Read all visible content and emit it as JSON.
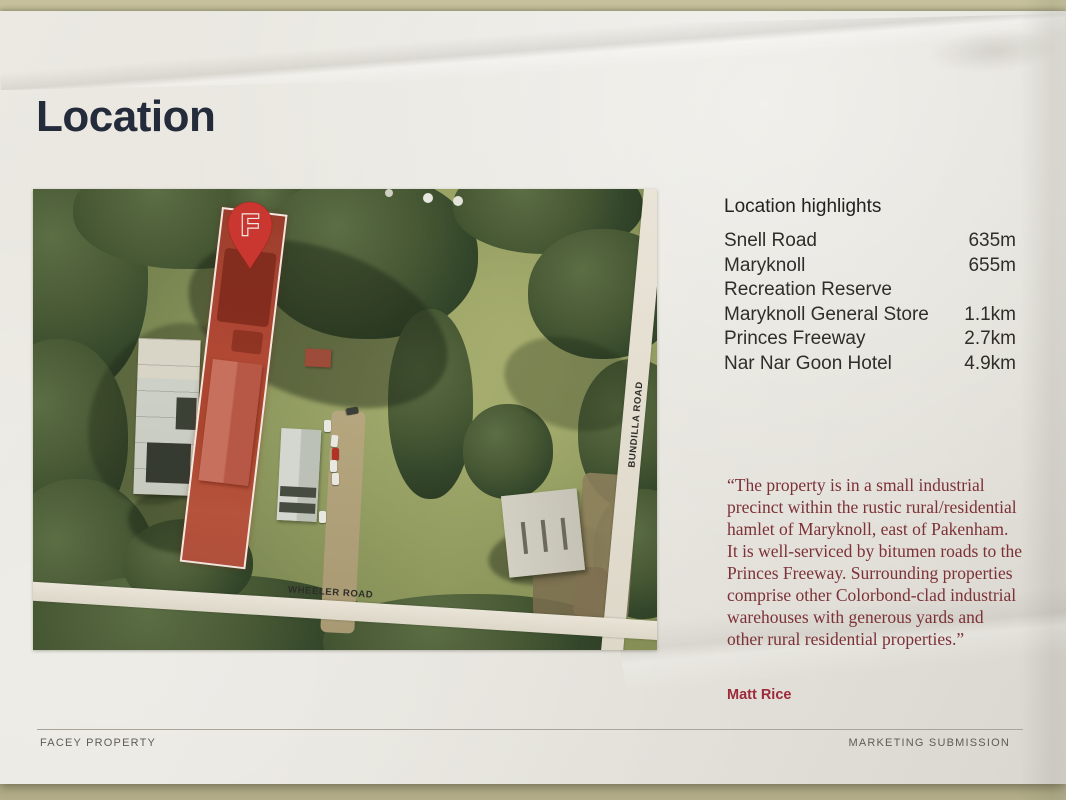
{
  "page": {
    "title": "Location",
    "footer": {
      "left": "FACEY PROPERTY",
      "right": "MARKETING SUBMISSION"
    }
  },
  "highlights": {
    "heading": "Location highlights",
    "rows": [
      {
        "label": "Snell Road",
        "value": "635m"
      },
      {
        "label": "Maryknoll",
        "value": "655m"
      },
      {
        "label": "Recreation Reserve",
        "value": ""
      },
      {
        "label": "Maryknoll General Store",
        "value": "1.1km"
      },
      {
        "label": "Princes Freeway",
        "value": "2.7km"
      },
      {
        "label": "Nar Nar Goon Hotel",
        "value": "4.9km"
      }
    ]
  },
  "quote": {
    "text": "“The property is in a small industrial precinct within the rustic rural/residential hamlet of Maryknoll, east of Pakenham. It is well-serviced by bitumen roads to the Princes Freeway. Surrounding properties comprise other Colorbond-clad industrial warehouses with generous yards and other rural residential properties.”",
    "attribution": "Matt Rice"
  },
  "map": {
    "marker_letter": "F",
    "roads": {
      "wheeler": "WHEELER ROAD",
      "bundilla": "BUNDILLA ROAD"
    }
  },
  "colors": {
    "pin_red": "#c93730",
    "parcel_tint": "#a84836",
    "quote_maroon": "#7c3138",
    "title_navy": "#242b3a",
    "paper": "#e8e6df"
  }
}
